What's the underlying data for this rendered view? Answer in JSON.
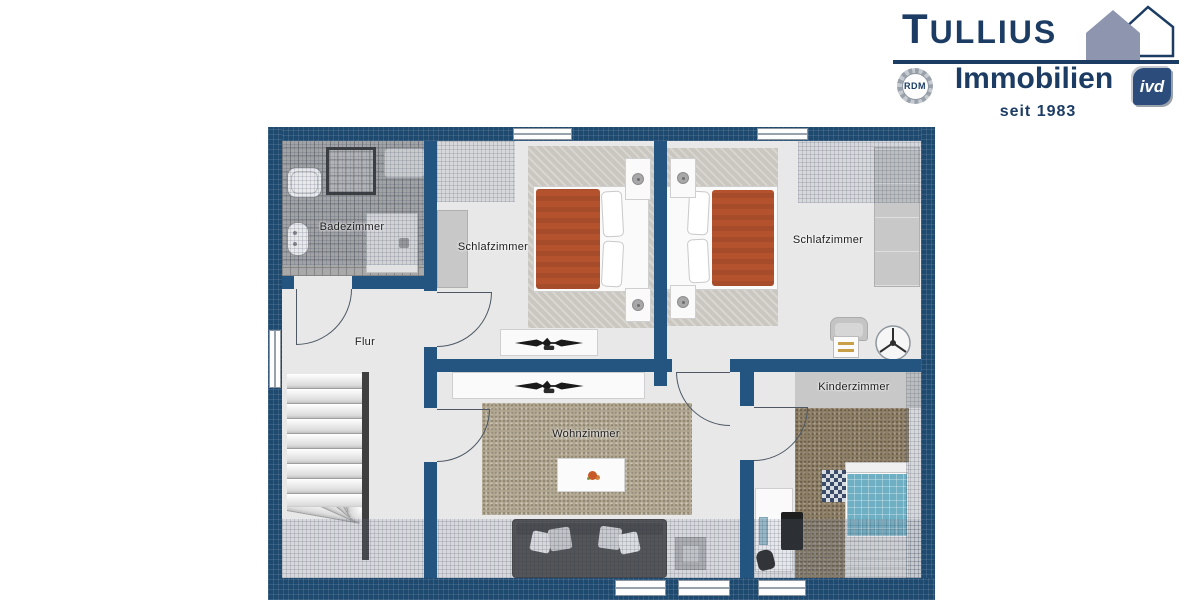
{
  "logo": {
    "brand": "TULLIUS",
    "brand_initial": "T",
    "brand_rest": "ULLIUS",
    "division": "Immobilien",
    "since": "seit 1983",
    "rdm_badge": "RDM",
    "ivd_badge": "ivd",
    "colors": {
      "navy": "#1c3c64",
      "house_fill": "#8d96ae",
      "seal_gray": "#9aa1ab",
      "ivd_background": "#2c4d7c"
    }
  },
  "floorplan": {
    "rooms": {
      "badezimmer": {
        "label": "Badezimmer"
      },
      "schlafzimmer_links": {
        "label": "Schlafzimmer"
      },
      "schlafzimmer_rechts": {
        "label": "Schlafzimmer"
      },
      "flur": {
        "label": "Flur"
      },
      "wohnzimmer": {
        "label": "Wohnzimmer"
      },
      "kinderzimmer": {
        "label": "Kinderzimmer"
      }
    },
    "colors": {
      "wall_navy": "#1e4a70",
      "inner_wall": "#245480",
      "floor_gray": "#e8e8e8",
      "bath_tile": "#a9a9a9",
      "bed_duvet_orange": "#b4522e",
      "kids_bed_teal": "#6fafc3",
      "living_carpet_beige": "#b1a791",
      "kids_carpet_brown": "#8d7e66",
      "sofa_gray": "#4b4b4b"
    },
    "furniture_icons": [
      "bathtub",
      "shower-cabin",
      "washbasin",
      "toilet",
      "walk-in-shower",
      "double-bed",
      "nightstand",
      "bedside-lamp",
      "wardrobe",
      "tv-sideboard",
      "staircase",
      "sofa",
      "coffee-table",
      "flower-decor",
      "side-table",
      "ceiling-fan",
      "chair",
      "desk",
      "computer-monitor",
      "office-chair",
      "single-bed",
      "checkered-pillow"
    ]
  }
}
